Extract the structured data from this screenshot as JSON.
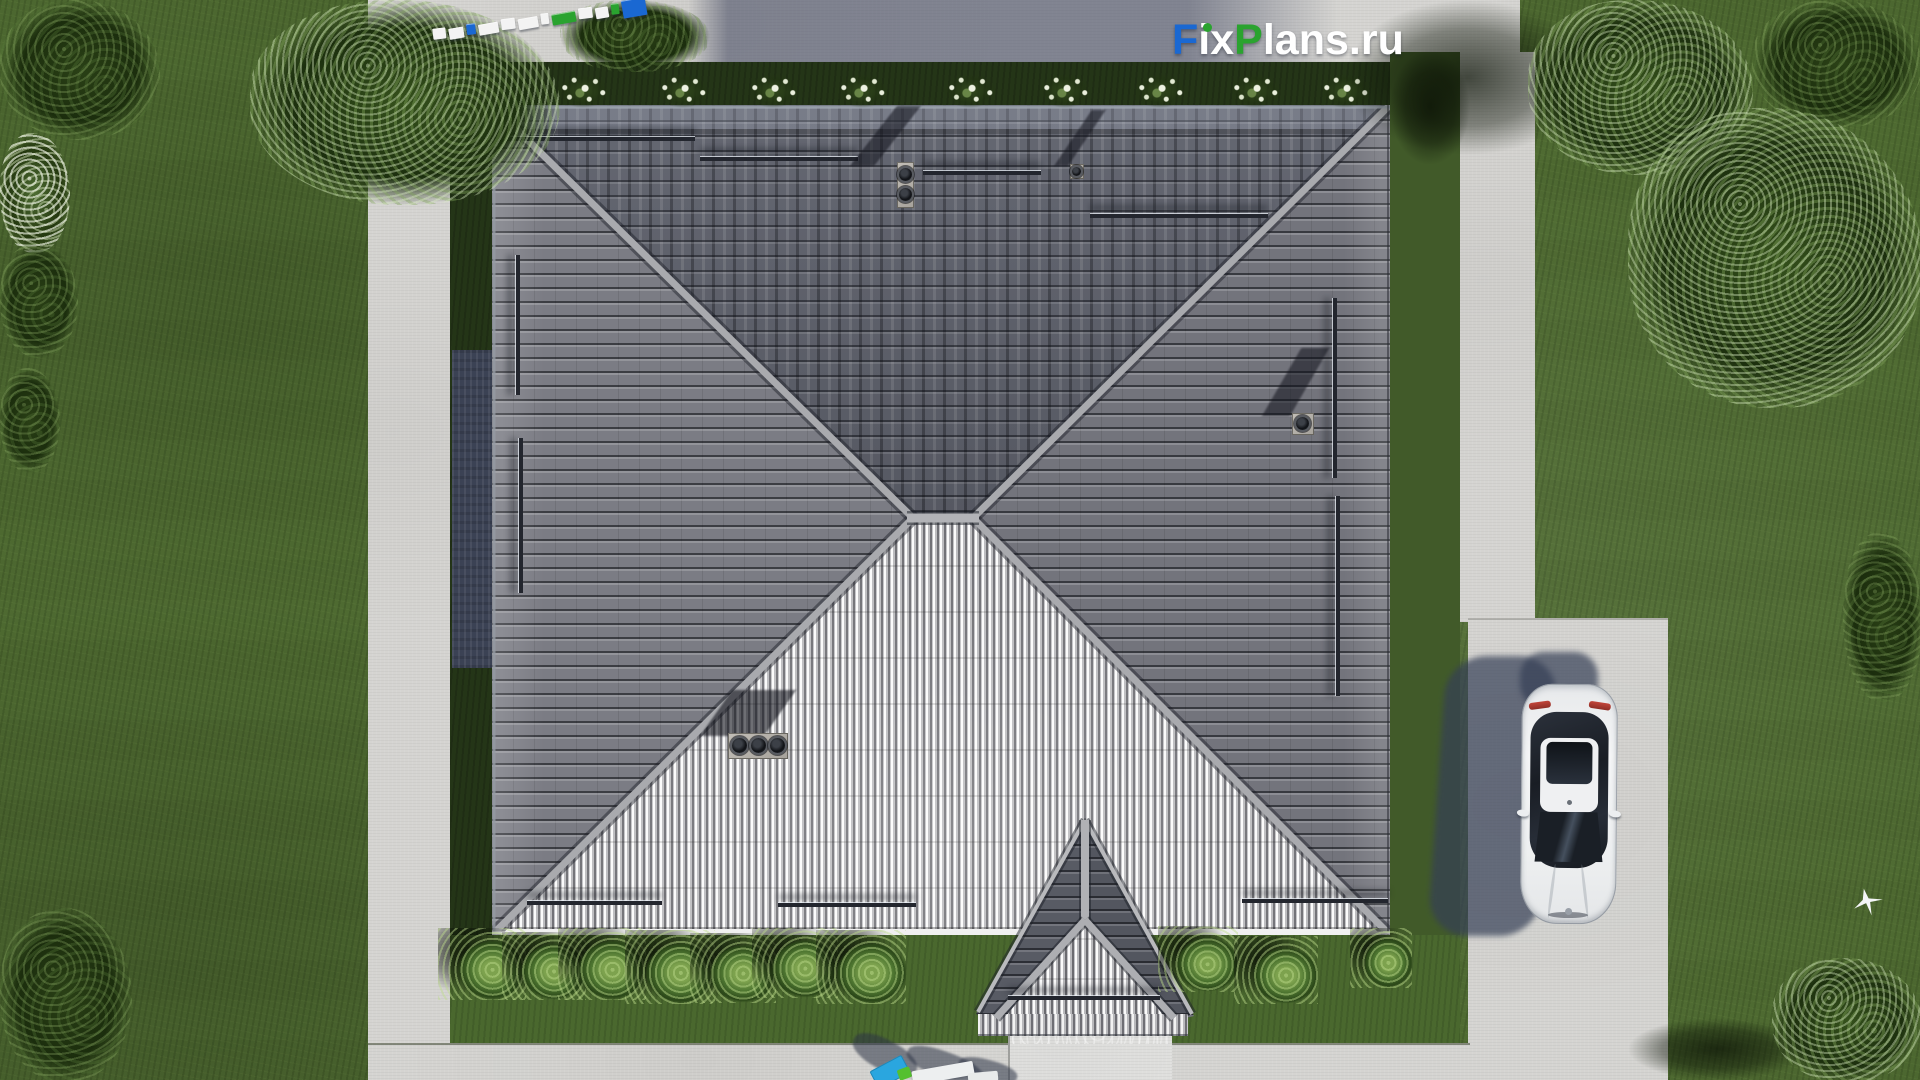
{
  "watermark": {
    "f": "F",
    "ix": "ix",
    "p": "P",
    "lans": "lans",
    "dot_ru": ".ru"
  },
  "colors": {
    "logo-blue": "#1a68d2",
    "logo-green": "#2aa32f",
    "logo-white": "#ffffff",
    "grass": "#4e6a31",
    "path": "#d5d4d1",
    "wall-shadow": "#3b4254",
    "roof-north": "#5c5f6a",
    "roof-east": "#73747c",
    "roof-west": "#7b7c84",
    "roof-south": "#b8b8ba",
    "ridge": "#a9aaae",
    "car-white": "#f2f3f4",
    "seg-white": "#f3f3f3",
    "seg-blue": "#1a68d2",
    "seg-green": "#2aa32f"
  },
  "scale_bar": {
    "segments": [
      {
        "style": {
          "width": "13px",
          "background": "var(--seg-white)"
        }
      },
      {
        "style": {
          "width": "15px",
          "background": "var(--seg-white)"
        }
      },
      {
        "style": {
          "width": "9px",
          "background": "var(--seg-blue)"
        }
      },
      {
        "style": {
          "width": "20px",
          "background": "var(--seg-white)"
        }
      },
      {
        "style": {
          "width": "14px",
          "background": "var(--seg-white)"
        }
      },
      {
        "style": {
          "width": "20px",
          "background": "var(--seg-white)"
        }
      },
      {
        "style": {
          "width": "8px",
          "background": "var(--seg-white)"
        }
      },
      {
        "style": {
          "width": "24px",
          "background": "var(--seg-green)"
        }
      },
      {
        "style": {
          "width": "14px",
          "background": "var(--seg-white)"
        }
      },
      {
        "style": {
          "width": "13px",
          "background": "var(--seg-white)"
        }
      },
      {
        "style": {
          "width": "8px",
          "background": "var(--seg-green)"
        }
      },
      {
        "style": {
          "width": "24px",
          "height": "18px",
          "background": "var(--seg-blue)"
        }
      }
    ]
  },
  "roof": {
    "rails": [
      {
        "cls": "rail rail-h",
        "style": {
          "left": "505px",
          "top": "137px",
          "width": "190px"
        }
      },
      {
        "cls": "rail rail-h",
        "style": {
          "left": "700px",
          "top": "157px",
          "width": "158px"
        }
      },
      {
        "cls": "rail rail-h",
        "style": {
          "left": "923px",
          "top": "171px",
          "width": "118px"
        }
      },
      {
        "cls": "rail rail-h",
        "style": {
          "left": "1090px",
          "top": "214px",
          "width": "178px"
        }
      },
      {
        "cls": "rail rail-v",
        "style": {
          "left": "516px",
          "top": "255px",
          "height": "140px"
        }
      },
      {
        "cls": "rail rail-v",
        "style": {
          "left": "519px",
          "top": "438px",
          "height": "155px"
        }
      },
      {
        "cls": "rail rail-v",
        "style": {
          "left": "1333px",
          "top": "298px",
          "height": "180px"
        }
      },
      {
        "cls": "rail rail-v",
        "style": {
          "left": "1336px",
          "top": "496px",
          "height": "200px"
        }
      },
      {
        "cls": "rail rail-h",
        "style": {
          "left": "527px",
          "top": "901px",
          "width": "135px"
        }
      },
      {
        "cls": "rail rail-h",
        "style": {
          "left": "778px",
          "top": "903px",
          "width": "138px"
        }
      },
      {
        "cls": "rail rail-h",
        "style": {
          "left": "1242px",
          "top": "899px",
          "width": "146px"
        }
      },
      {
        "cls": "rail rail-h",
        "style": {
          "left": "1008px",
          "top": "996px",
          "width": "152px"
        }
      }
    ]
  },
  "landscape": {
    "flowers": [
      {
        "style": {
          "left": "464px",
          "top": "74px",
          "width": "52px",
          "height": "34px"
        }
      },
      {
        "style": {
          "left": "557px",
          "top": "74px",
          "width": "52px",
          "height": "34px"
        }
      },
      {
        "style": {
          "left": "657px",
          "top": "74px",
          "width": "52px",
          "height": "34px"
        }
      },
      {
        "style": {
          "left": "747px",
          "top": "74px",
          "width": "52px",
          "height": "34px"
        }
      },
      {
        "style": {
          "left": "836px",
          "top": "74px",
          "width": "52px",
          "height": "34px"
        }
      },
      {
        "style": {
          "left": "944px",
          "top": "74px",
          "width": "52px",
          "height": "34px"
        }
      },
      {
        "style": {
          "left": "1039px",
          "top": "74px",
          "width": "52px",
          "height": "34px"
        }
      },
      {
        "style": {
          "left": "1134px",
          "top": "74px",
          "width": "52px",
          "height": "34px"
        }
      },
      {
        "style": {
          "left": "1229px",
          "top": "74px",
          "width": "52px",
          "height": "34px"
        }
      },
      {
        "style": {
          "left": "1319px",
          "top": "74px",
          "width": "52px",
          "height": "34px"
        }
      }
    ],
    "bushes": [
      {
        "style": {
          "left": "438px",
          "top": "928px",
          "width": "88px",
          "height": "72px"
        }
      },
      {
        "style": {
          "left": "502px",
          "top": "932px",
          "width": "84px",
          "height": "68px"
        }
      },
      {
        "style": {
          "left": "558px",
          "top": "928px",
          "width": "88px",
          "height": "72px"
        }
      },
      {
        "style": {
          "left": "625px",
          "top": "930px",
          "width": "90px",
          "height": "74px"
        }
      },
      {
        "style": {
          "left": "690px",
          "top": "933px",
          "width": "86px",
          "height": "70px"
        }
      },
      {
        "style": {
          "left": "752px",
          "top": "928px",
          "width": "86px",
          "height": "70px"
        }
      },
      {
        "style": {
          "left": "816px",
          "top": "930px",
          "width": "90px",
          "height": "74px"
        }
      },
      {
        "style": {
          "left": "1158px",
          "top": "926px",
          "width": "80px",
          "height": "66px"
        }
      },
      {
        "style": {
          "left": "1234px",
          "top": "936px",
          "width": "84px",
          "height": "68px"
        }
      },
      {
        "style": {
          "left": "1350px",
          "top": "928px",
          "width": "62px",
          "height": "60px"
        }
      }
    ],
    "trees": [
      {
        "cls": "tree t-dark",
        "style": {
          "left": "0px",
          "top": "0px",
          "width": "160px",
          "height": "140px"
        }
      },
      {
        "cls": "tree t-bright",
        "style": {
          "left": "250px",
          "top": "0px",
          "width": "310px",
          "height": "205px"
        }
      },
      {
        "cls": "tree t-dark",
        "style": {
          "left": "560px",
          "top": "0px",
          "width": "150px",
          "height": "72px"
        }
      },
      {
        "cls": "tree t-flower",
        "style": {
          "left": "0px",
          "top": "133px",
          "width": "70px",
          "height": "120px"
        }
      },
      {
        "cls": "tree t-dark",
        "style": {
          "left": "0px",
          "top": "243px",
          "width": "78px",
          "height": "115px"
        }
      },
      {
        "cls": "tree t-dark",
        "style": {
          "left": "0px",
          "top": "368px",
          "width": "60px",
          "height": "105px"
        }
      },
      {
        "cls": "tree t-dark",
        "style": {
          "left": "0px",
          "top": "908px",
          "width": "132px",
          "height": "175px"
        }
      },
      {
        "cls": "tree t-bright",
        "style": {
          "left": "1528px",
          "top": "0px",
          "width": "225px",
          "height": "175px"
        }
      },
      {
        "cls": "tree t-dark",
        "style": {
          "left": "1752px",
          "top": "0px",
          "width": "170px",
          "height": "128px"
        }
      },
      {
        "cls": "tree t-bright",
        "style": {
          "left": "1628px",
          "top": "108px",
          "width": "295px",
          "height": "300px"
        }
      },
      {
        "cls": "tree t-dark",
        "style": {
          "left": "1843px",
          "top": "532px",
          "width": "80px",
          "height": "170px"
        }
      },
      {
        "cls": "tree t-bright",
        "style": {
          "left": "1772px",
          "top": "958px",
          "width": "150px",
          "height": "125px"
        }
      }
    ],
    "shadows": [
      {
        "style": {
          "left": "1345px",
          "top": "0px",
          "width": "245px",
          "height": "155px"
        }
      },
      {
        "style": {
          "left": "1628px",
          "top": "1018px",
          "width": "180px",
          "height": "62px"
        }
      },
      {
        "style": {
          "left": "1390px",
          "top": "50px",
          "width": "80px",
          "height": "115px"
        }
      }
    ]
  }
}
